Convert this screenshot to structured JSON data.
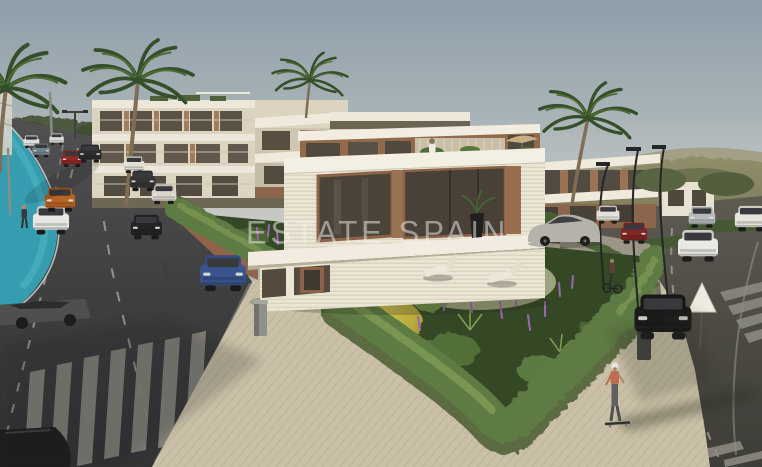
{
  "image": {
    "kind": "architectural-render",
    "subject": "modern residential complex with street scene, garden and palm trees",
    "width_px": 762,
    "height_px": 467
  },
  "watermark": {
    "text": "ESTATE SPAIN",
    "color": "rgba(242,242,239,0.5)"
  },
  "palette": {
    "sky_top": "#8c9dab",
    "sky_horizon": "#cbcbc5",
    "hills": "#7c7b58",
    "asphalt": "#3a3a3d",
    "sidewalk": "#c9c0a8",
    "bike_lane": "#2f9cb0",
    "hedge": "#5a7840",
    "hedge_highlight": "#7b9a52",
    "garden_foliage": "#2f4322",
    "garden_yellow": "#c8ba3c",
    "garden_purple": "#9a63b0",
    "building_white": "#f4efe3",
    "building_cream": "#ddd5c2",
    "wood_accent": "#966b4c",
    "glass_dark": "#483f36",
    "crosswalk_stripe": "#8d8b82"
  },
  "scene": {
    "vehicles": [
      {
        "name": "blue-sedan-parked",
        "color": "#35508f"
      },
      {
        "name": "white-sedan-parked",
        "color": "#e9e9e7"
      },
      {
        "name": "orange-suv-parked",
        "color": "#b8601f"
      },
      {
        "name": "red-hatchback-far",
        "color": "#8f2222"
      },
      {
        "name": "black-suv-far",
        "color": "#25262a"
      },
      {
        "name": "white-car-far-1",
        "color": "#dededa"
      },
      {
        "name": "gray-car-far",
        "color": "#70808a"
      },
      {
        "name": "white-car-far-2",
        "color": "#d9d9d5"
      },
      {
        "name": "black-car-driving",
        "color": "#1c1d1f"
      },
      {
        "name": "white-van-curb",
        "color": "#e2dfd8"
      },
      {
        "name": "dark-car-curb",
        "color": "#2e2e31"
      },
      {
        "name": "white-car-curb",
        "color": "#dcd7cc"
      },
      {
        "name": "white-sedan-oncoming",
        "color": "#edebe7"
      },
      {
        "name": "red-car-right-road",
        "color": "#7e2020"
      },
      {
        "name": "white-suv-right-road",
        "color": "#e4e2dc"
      },
      {
        "name": "silver-car-far-right",
        "color": "#b6b9bd"
      },
      {
        "name": "black-car-parked-corner",
        "color": "#131315"
      },
      {
        "name": "white-car-right-edge",
        "color": "#e7e5df"
      },
      {
        "name": "silver-sedan-by-villa",
        "color": "#b4b1aa"
      },
      {
        "name": "gray-sedan-by-crosswalk",
        "color": "#4a4a4e"
      },
      {
        "name": "dark-car-bottom-corner",
        "color": "#17171a"
      }
    ],
    "people": [
      "pedestrian-on-bike-lane",
      "person-on-roof-terrace",
      "skateboarder-on-sidewalk",
      "cyclist-by-wall"
    ],
    "street_furniture": [
      "yield-sign",
      "trash-bin-left",
      "trash-bin-right",
      "street-lamps-right",
      "light-pole-left"
    ],
    "vegetation": [
      "palm-tree-left-edge",
      "palm-tree-tall-left",
      "palm-tree-center",
      "palm-tree-right",
      "corner-hedge",
      "tropical-garden"
    ]
  }
}
